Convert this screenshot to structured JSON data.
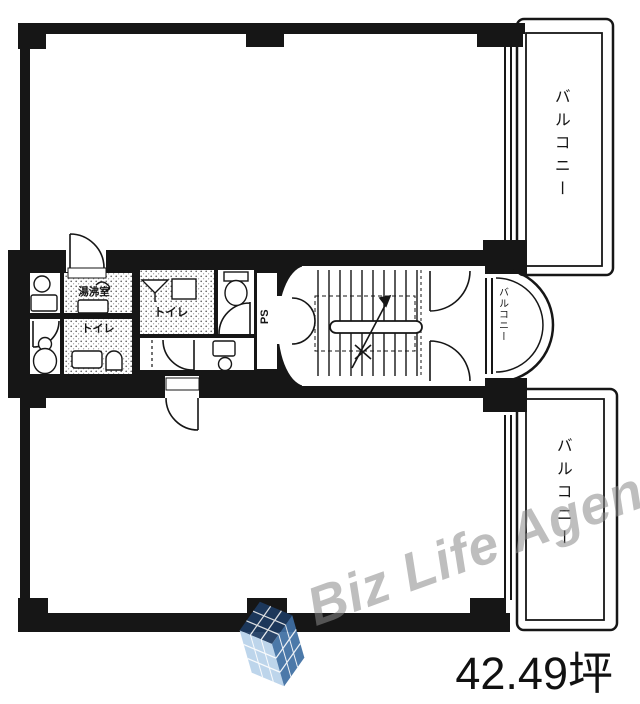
{
  "floorplan": {
    "area_text": "42.49坪",
    "watermark_text": "Biz Life Agent",
    "labels": {
      "kitchenette": "湯沸室",
      "toilet_left": "トイレ",
      "toilet_right": "トイレ",
      "pipe_space": "PS",
      "balcony_top": "バルコニー",
      "balcony_middle": "バルコニー",
      "balcony_bottom": "バルコニー"
    },
    "colors": {
      "wall": "#161616",
      "watermark_gray": "#8a8a8a",
      "logo_cube_dark": "#1d3a60",
      "logo_cube_mid": "#3f6fa3",
      "logo_cube_light": "#b9d2ea"
    }
  }
}
